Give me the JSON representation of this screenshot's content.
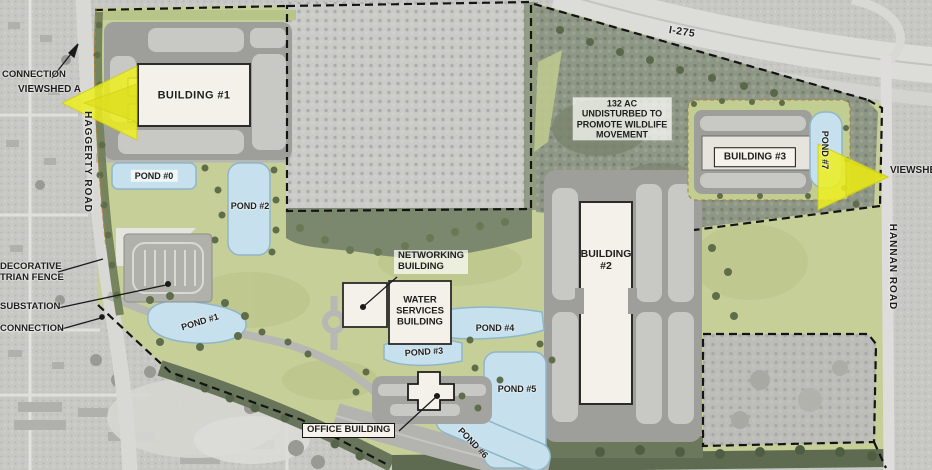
{
  "labels": {
    "connection_top": "CONNECTION",
    "viewshed_a": "VIEWSHED A",
    "haggerty_road": "HAGGERTY ROAD",
    "building_1": "BUILDING #1",
    "pond_0": "POND #0",
    "pond_2": "POND #2",
    "fence": [
      "DECORATIVE",
      "TRIAN FENCE"
    ],
    "substation": "SUBSTATION",
    "connection_bottom": "CONNECTION",
    "pond_1": "POND #1",
    "networking": [
      "NETWORKING",
      "BUILDING"
    ],
    "water_services": [
      "WATER",
      "SERVICES",
      "BUILDING"
    ],
    "pond_3": "POND #3",
    "pond_4": "POND #4",
    "pond_5": "POND #5",
    "office_building": "OFFICE BUILDING",
    "pond_6": "POND #6",
    "building_2": [
      "BUILDING",
      "#2"
    ],
    "wildlife": [
      "132 AC",
      "UNDISTURBED TO",
      "PROMOTE WILDLIFE",
      "MOVEMENT"
    ],
    "building_3": "BUILDING #3",
    "pond_7": "POND #7",
    "viewshed_b": "VIEWSHED",
    "hannan_road": "HANNAN ROAD",
    "highway": "I-275"
  },
  "colors": {
    "site_green": "#c6cf97",
    "pond_blue": "#c6e1ed",
    "building_fill": "#f4f1ea",
    "viewshed_yellow": "#eef01f",
    "parking_gray": "#9e9e9a",
    "parking_row_gray": "#c8c8c4",
    "aerial_gray": "#c7c7c4",
    "wooded_dark": "#8e9786",
    "boundary_black": "#141414"
  }
}
